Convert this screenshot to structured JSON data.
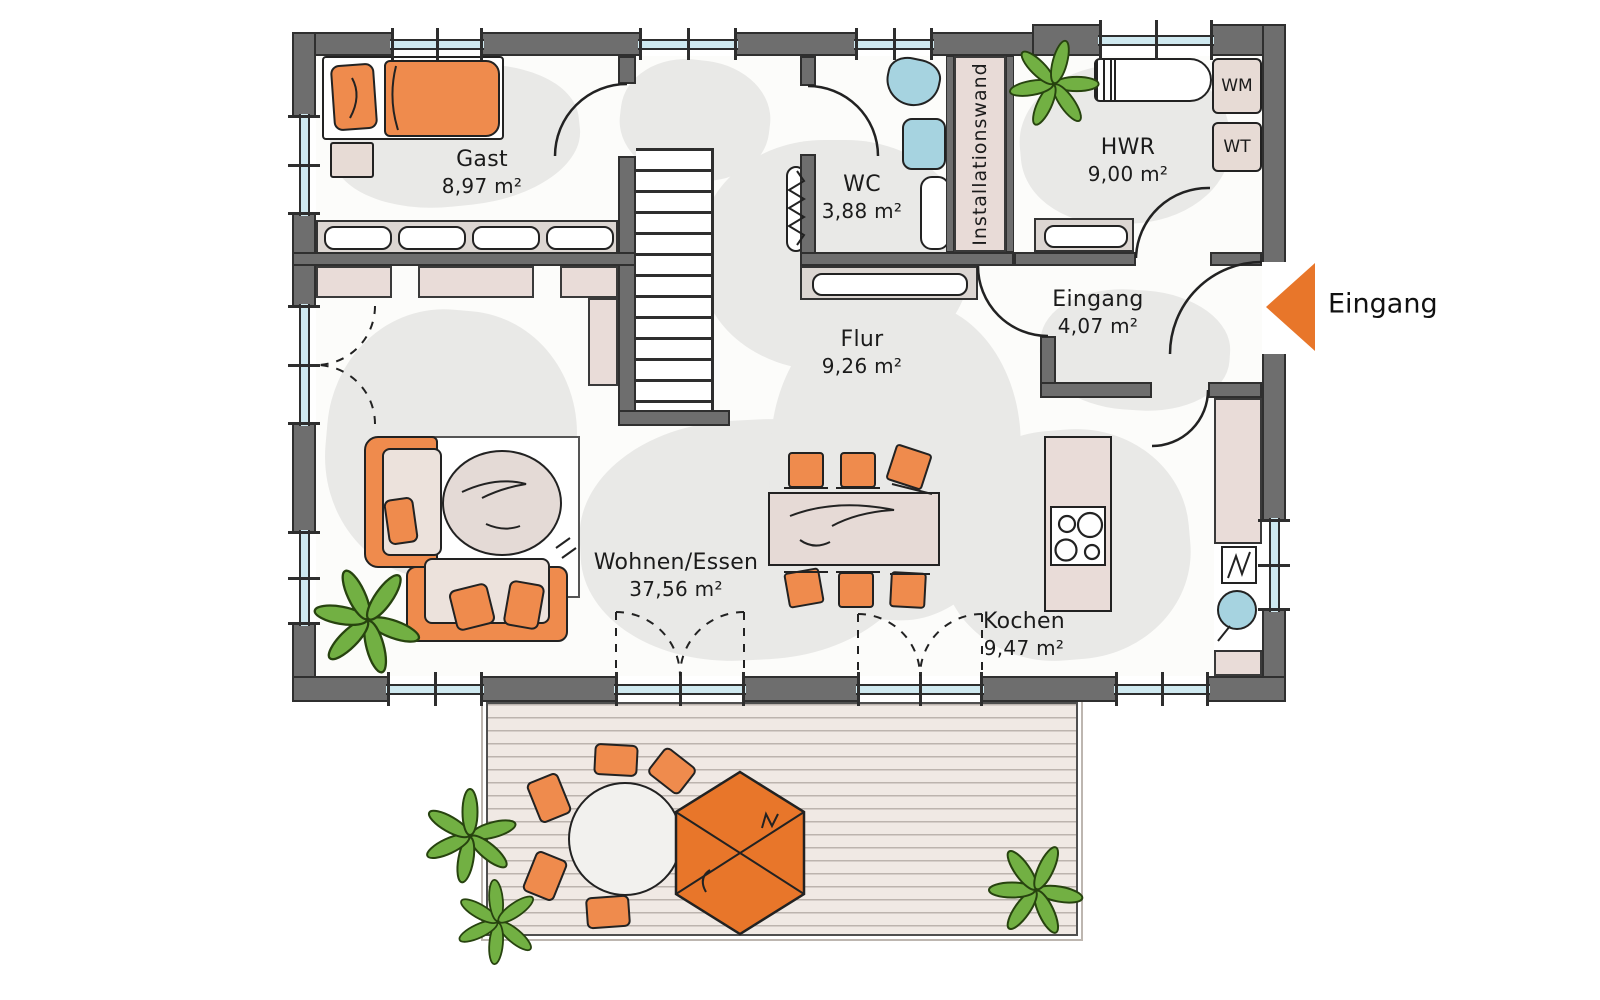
{
  "rooms": {
    "gast": {
      "name": "Gast",
      "area": "8,97 m²"
    },
    "wc": {
      "name": "WC",
      "area": "3,88 m²"
    },
    "hwr": {
      "name": "HWR",
      "area": "9,00 m²"
    },
    "eingang": {
      "name": "Eingang",
      "area": "4,07 m²"
    },
    "flur": {
      "name": "Flur",
      "area": "9,26 m²"
    },
    "wohnen_essen": {
      "name": "Wohnen/Essen",
      "area": "37,56 m²"
    },
    "kochen": {
      "name": "Kochen",
      "area": "9,47 m²"
    }
  },
  "labels": {
    "installationswand": "Installationswand",
    "washing_machine": "WM",
    "dryer": "WT",
    "entrance_arrow_label": "Eingang"
  },
  "colors": {
    "wall_gray": "#6e6e6e",
    "accent_orange": "#ef8b4d",
    "arrow_orange": "#e8762a",
    "glass_blue": "#cfe9f0",
    "fixture_blue": "#a6d3e0",
    "plant_green": "#72b043",
    "furniture_beige": "#e7dbd5",
    "counter_rose": "#e9dcd8"
  }
}
